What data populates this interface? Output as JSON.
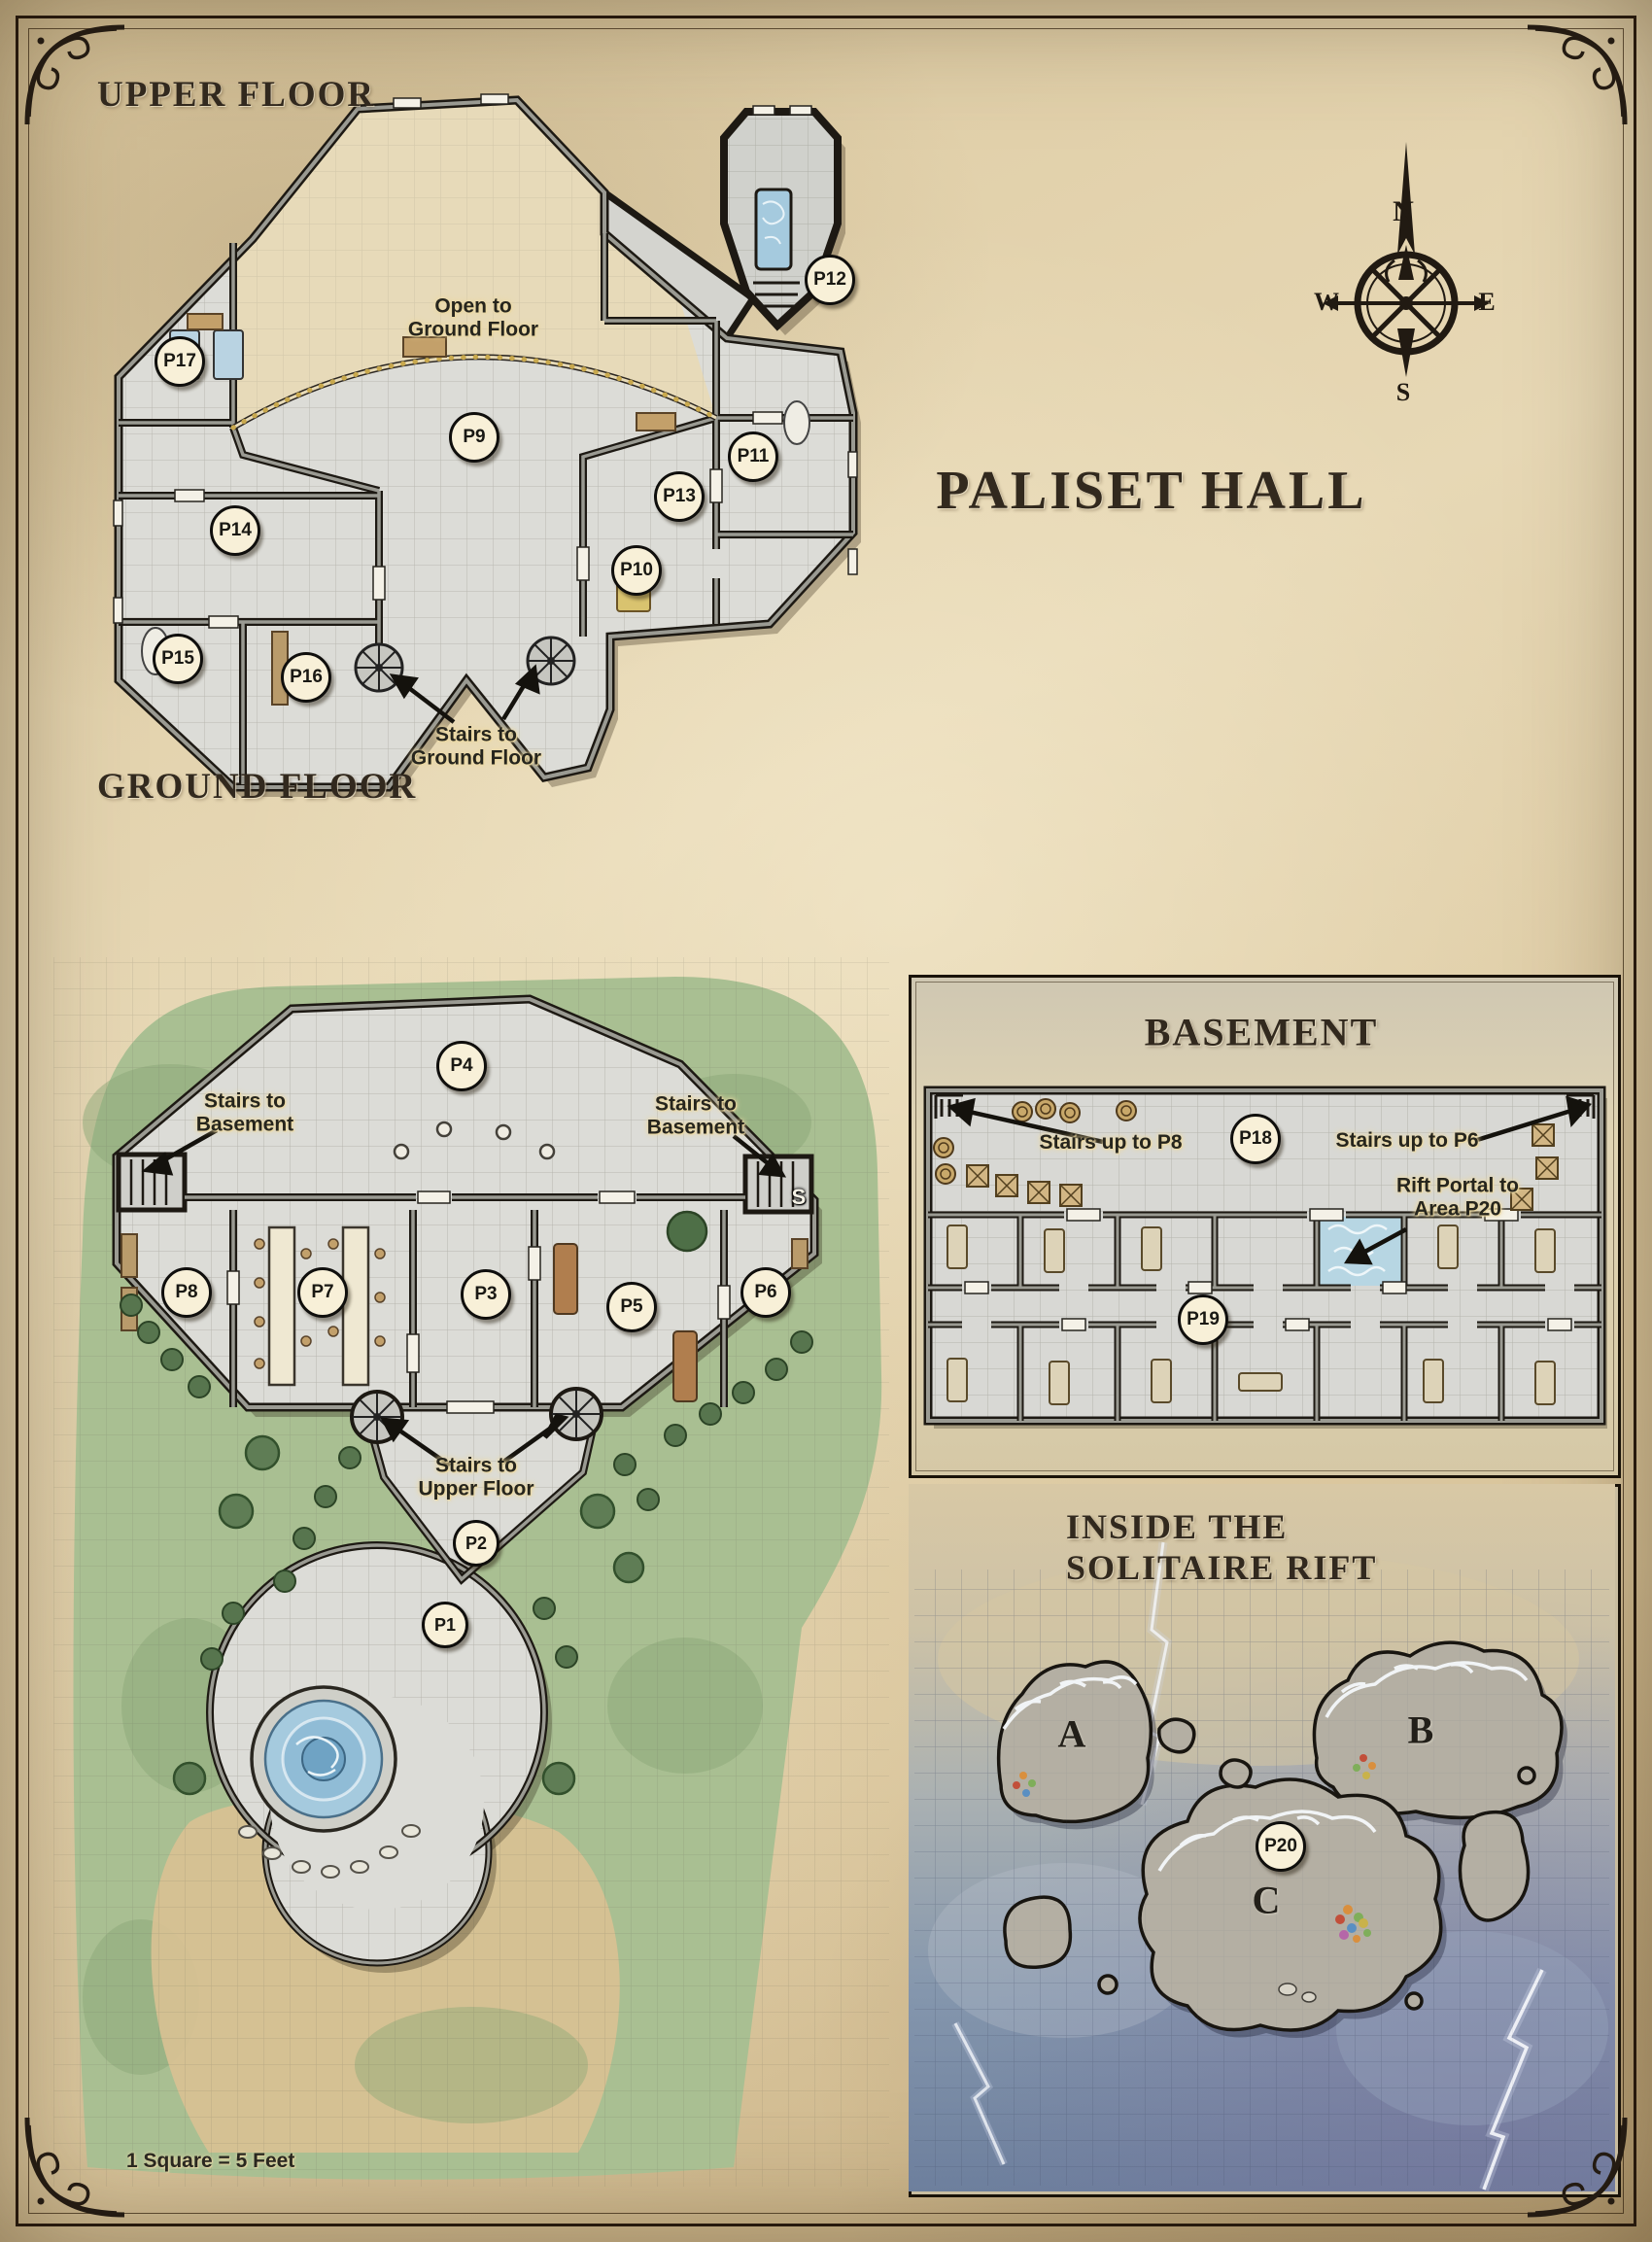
{
  "page": {
    "title": "Paliset Hall",
    "scale_note": "1 Square = 5 Feet"
  },
  "compass": {
    "north": "N",
    "east": "E",
    "south": "S",
    "west": "W"
  },
  "upper_floor": {
    "heading": "Upper Floor",
    "open_note": "Open to\nGround Floor",
    "stairs_note": "Stairs to\nGround Floor",
    "rooms": [
      "P9",
      "P10",
      "P11",
      "P12",
      "P13",
      "P14",
      "P15",
      "P16",
      "P17"
    ]
  },
  "ground_floor": {
    "heading": "Ground Floor",
    "stairs_basement_left_note": "Stairs to\nBasement",
    "stairs_basement_right_note": "Stairs to\nBasement",
    "stairs_marker": "S",
    "stairs_upper_note": "Stairs to\nUpper Floor",
    "rooms": [
      "P1",
      "P2",
      "P3",
      "P4",
      "P5",
      "P6",
      "P7",
      "P8"
    ]
  },
  "basement": {
    "heading": "Basement",
    "stairs_p8_note": "Stairs up to P8",
    "stairs_p6_note": "Stairs up to P6",
    "rift_portal_note": "Rift Portal to\nArea P20",
    "rooms": [
      "P18",
      "P19"
    ]
  },
  "rift": {
    "heading": "Inside the Solitaire Rift",
    "islands": [
      "A",
      "B",
      "C"
    ],
    "rooms": [
      "P20"
    ]
  },
  "colors": {
    "parchment": "#e3d3ae",
    "wall_dark": "#1d1913",
    "floor_grey": "#dcdcd7",
    "open_area_tan": "#e7dab7",
    "grass_green": "#a9bf92",
    "water_blue": "#a5cade",
    "badge_cream": "#f8f0d8",
    "rift_mist_blue": "#7c90ab",
    "bead_gold": "#c9a94e"
  }
}
